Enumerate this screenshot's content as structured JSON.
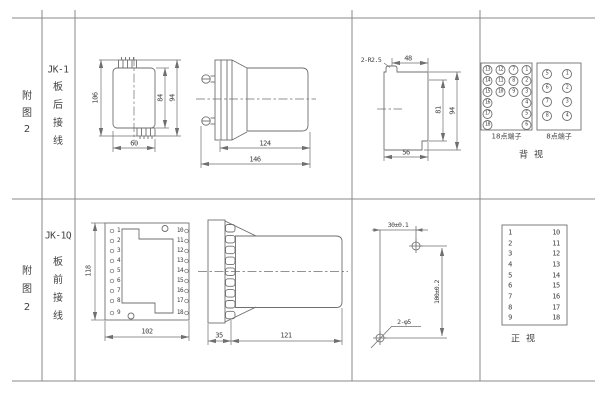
{
  "figure1": {
    "row_label": [
      "附",
      "图",
      "2"
    ],
    "model": "JK-1",
    "mount_label": [
      "板",
      "后",
      "接",
      "线"
    ],
    "front_view": {
      "dim_height": "106",
      "dim_inner_height": "84",
      "dim_mid_height": "94",
      "dim_width": "60"
    },
    "side_view": {
      "dim_body": "124",
      "dim_total": "146"
    },
    "panel_view": {
      "dim_radius": "2-R2.5",
      "dim_top_width": "48",
      "dim_inner_height": "81",
      "dim_height": "94",
      "dim_width": "56"
    },
    "terminals18": {
      "label": "18点端子",
      "numbers": [
        "13",
        "12",
        "7",
        "1",
        "14",
        "11",
        "8",
        "2",
        "15",
        "10",
        "9",
        "3",
        "16",
        "4",
        "17",
        "5",
        "18",
        "6"
      ]
    },
    "terminals8": {
      "label": "8点端子",
      "numbers": [
        "5",
        "1",
        "6",
        "2",
        "7",
        "3",
        "8",
        "4"
      ]
    },
    "view_label": "背视"
  },
  "figure2": {
    "row_label": [
      "附",
      "图",
      "2"
    ],
    "model": "JK-1Q",
    "mount_label": [
      "板",
      "前",
      "接",
      "线"
    ],
    "front_view": {
      "left_terminals": [
        "1",
        "2",
        "3",
        "4",
        "5",
        "6",
        "7",
        "8",
        "9"
      ],
      "right_terminals": [
        "10",
        "11",
        "12",
        "13",
        "14",
        "15",
        "16",
        "17",
        "18"
      ],
      "dim_height": "118",
      "dim_width": "102"
    },
    "side_view": {
      "dim_plate": "35",
      "dim_body": "121"
    },
    "drill_view": {
      "dim_x": "30±0.1",
      "dim_y": "100±0.2",
      "holes_label": "2-φ5"
    },
    "terminal_list": {
      "left": [
        "1",
        "2",
        "3",
        "4",
        "5",
        "6",
        "7",
        "8",
        "9"
      ],
      "right": [
        "10",
        "11",
        "12",
        "13",
        "14",
        "15",
        "16",
        "17",
        "18"
      ]
    },
    "view_label": "正视"
  },
  "colors": {
    "line": "#6f6f6f",
    "text": "#3f3f3f",
    "background": "#ffffff"
  }
}
